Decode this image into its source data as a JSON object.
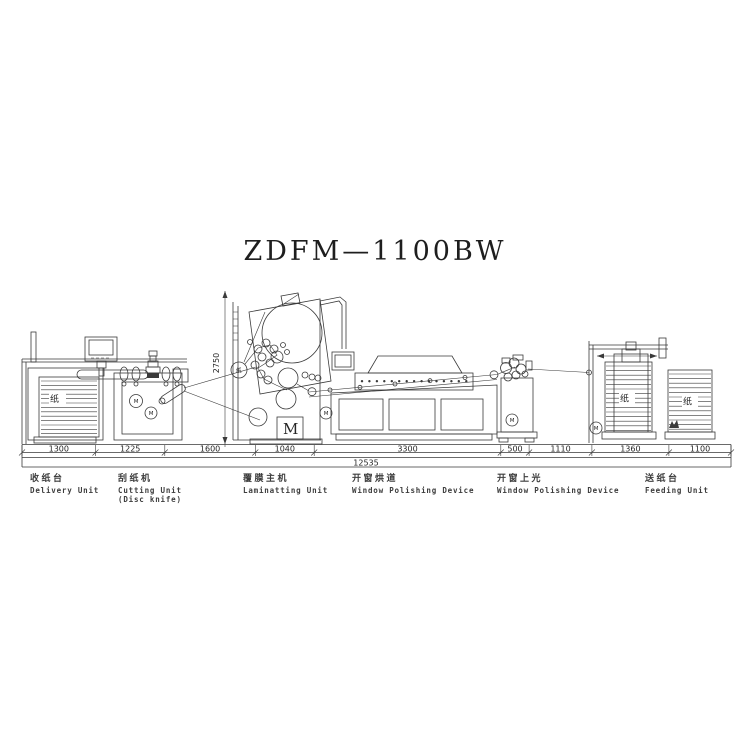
{
  "title": "ZDFM—1100BW",
  "drawing": {
    "paper_label": "纸",
    "motor_label": "M",
    "height_dimension": "2750"
  },
  "dimension_chain": {
    "total": "12535",
    "segments": [
      "1300",
      "1225",
      "1600",
      "1040",
      "3300",
      "500",
      "1110",
      "1360",
      "1100"
    ]
  },
  "unit_labels": [
    {
      "zh": "收纸台",
      "en1": "Delivery Unit",
      "en2": ""
    },
    {
      "zh": "刮纸机",
      "en1": "Cutting Unit",
      "en2": "(Disc knife)"
    },
    {
      "zh": "覆膜主机",
      "en1": "Laminatting Unit",
      "en2": ""
    },
    {
      "zh": "开窗烘道",
      "en1": "Window Polishing Device",
      "en2": ""
    },
    {
      "zh": "开窗上光",
      "en1": "Window Polishing Device",
      "en2": ""
    },
    {
      "zh": "送纸台",
      "en1": "Feeding Unit",
      "en2": ""
    }
  ],
  "colors": {
    "line": "#3a3a3a",
    "background": "#ffffff"
  }
}
